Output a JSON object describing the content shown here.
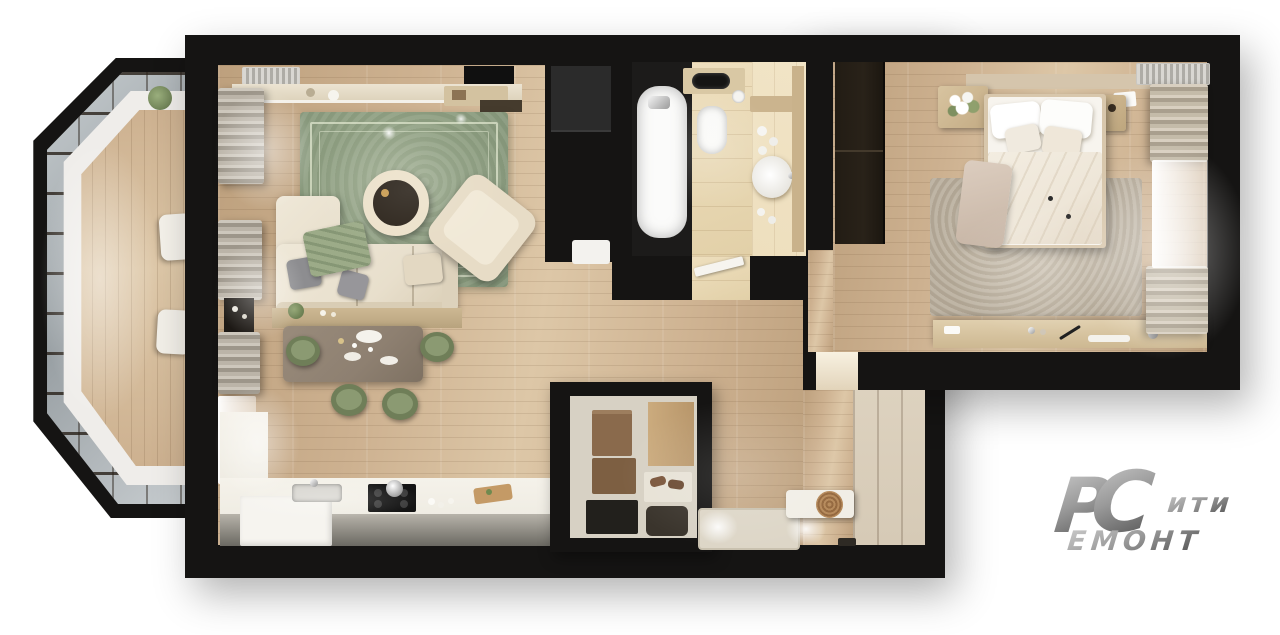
{
  "logo": {
    "monogram_p": "Р",
    "monogram_c": "С",
    "word_top": "ити",
    "word_bottom": "ЕМОНТ",
    "aria": "Сити Ремонт"
  },
  "palette": {
    "wall": "#151413",
    "wood": "#cdb190",
    "woodlight": "#ddc7a7",
    "wooddark": "#bda07d",
    "tile": "#e2d0a8",
    "tilelight": "#eedfbe",
    "ruggreen": "#91a184",
    "ruglinecolor": "#dde4cc",
    "sofa": "#e8dfcc",
    "pillowgray": "#8d8d90",
    "throwgreen": "#9cab88",
    "tabletaupe": "#8e8071",
    "chairgreen": "#6f7e58",
    "chairgreenlight": "#8b9a72",
    "counter": "#efece3",
    "counterface": "#6b6962",
    "cooktop": "#141414",
    "tub": "#fbfbfa",
    "bedwhite": "#f7f4ee",
    "bedbeige": "#eee6d8",
    "headboard": "#d5c5ac",
    "bedroomrug": "#b6ab99",
    "wardrobe": "#292219",
    "nook": "#d6cab6",
    "mat": "#ddd6c7",
    "closetwall": "#d7d1c4",
    "boxbrown": "#8a6a4c",
    "logolight": "#cacaca",
    "logodark": "#4d4d4d"
  }
}
